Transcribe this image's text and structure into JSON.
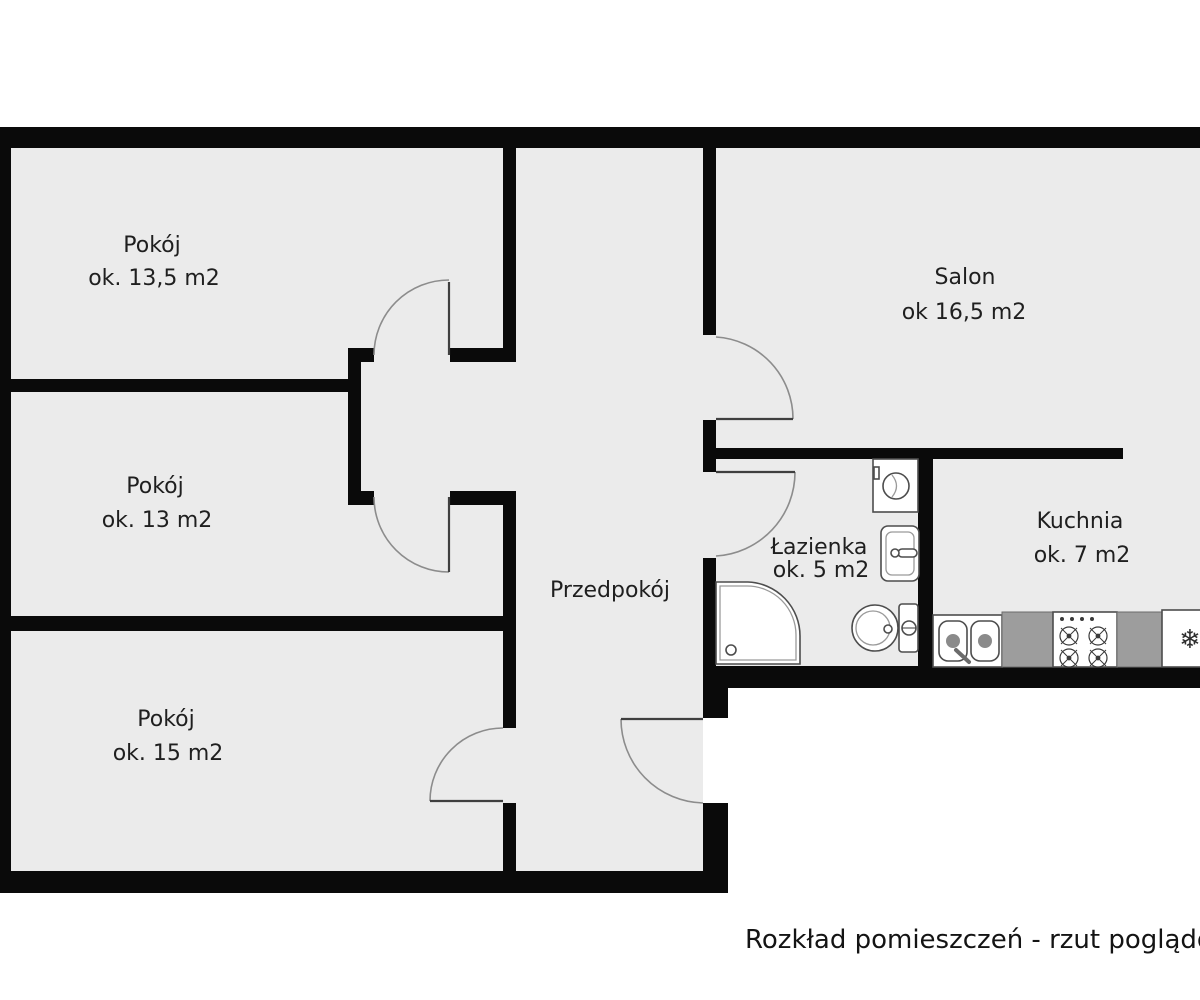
{
  "caption": "Rozkład pomieszczeń - rzut poglądow",
  "rooms": {
    "room1": {
      "name": "Pokój",
      "area": "ok. 13,5 m2"
    },
    "room2": {
      "name": "Pokój",
      "area": "ok. 13 m2"
    },
    "room3": {
      "name": "Pokój",
      "area": "ok. 15 m2"
    },
    "salon": {
      "name": "Salon",
      "area": "ok 16,5 m2"
    },
    "hall": {
      "name": "Przedpokój"
    },
    "bath": {
      "name": "Łazienka",
      "area": "ok. 5 m2"
    },
    "kitchen": {
      "name": "Kuchnia",
      "area": "ok. 7 m2"
    }
  },
  "fixtures": {
    "bathroom": [
      "washing-machine",
      "washbasin",
      "toilet",
      "shower"
    ],
    "kitchen": [
      "kitchen-sink",
      "counter",
      "stove",
      "counter",
      "fridge"
    ],
    "fridge_glyph": "❄"
  },
  "palette": {
    "wall": "#0a0a0a",
    "floor": "#ebebeb",
    "background": "#ffffff",
    "door_arc": "#8c8c8c",
    "counter_gray": "#9d9d9d",
    "text": "#1f1f1f"
  }
}
